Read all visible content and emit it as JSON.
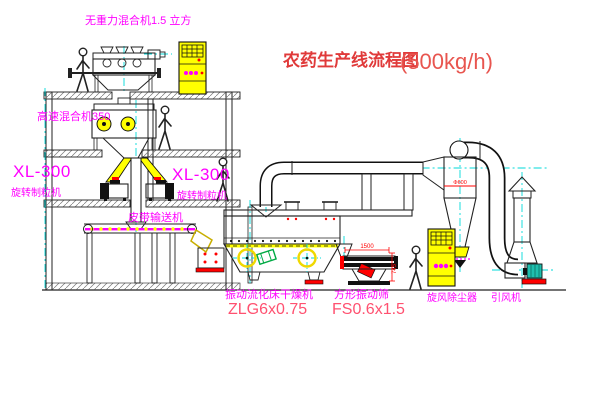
{
  "title": {
    "main": "农药生产线流程图",
    "capacity": "(500kg/h)"
  },
  "labels": {
    "mixer_top": "无重力混合机1.5 立方",
    "mixer_high_speed": "高速混合机350",
    "granulator_left_model": "XL-300",
    "granulator_left_name": "旋转制粒机",
    "granulator_right_model": "XL-300",
    "granulator_right_name": "旋转制粒机",
    "belt_conveyor": "皮带输送机",
    "dryer_name": "振动流化床干燥机",
    "dryer_model": "ZLG6x0.75",
    "sieve_name": "方形振动筛",
    "sieve_model": "FS0.6x1.5",
    "cyclone": "旋风除尘器",
    "fan": "引风机"
  },
  "dimensions": {
    "sieve_width": "1500",
    "sieve_height": "745",
    "cyclone_dia": "Φ600"
  },
  "colors": {
    "line": "#222222",
    "label_magenta": "#ff00ff",
    "title_red": "#e03a3a",
    "model_red": "#ff5170",
    "dimension_red": "#ff0000",
    "equipment_yellow": "#ffff00",
    "centerline_cyan": "#00d9d9",
    "motor_teal": "#1fbfae",
    "chute_green": "#00aa44"
  }
}
